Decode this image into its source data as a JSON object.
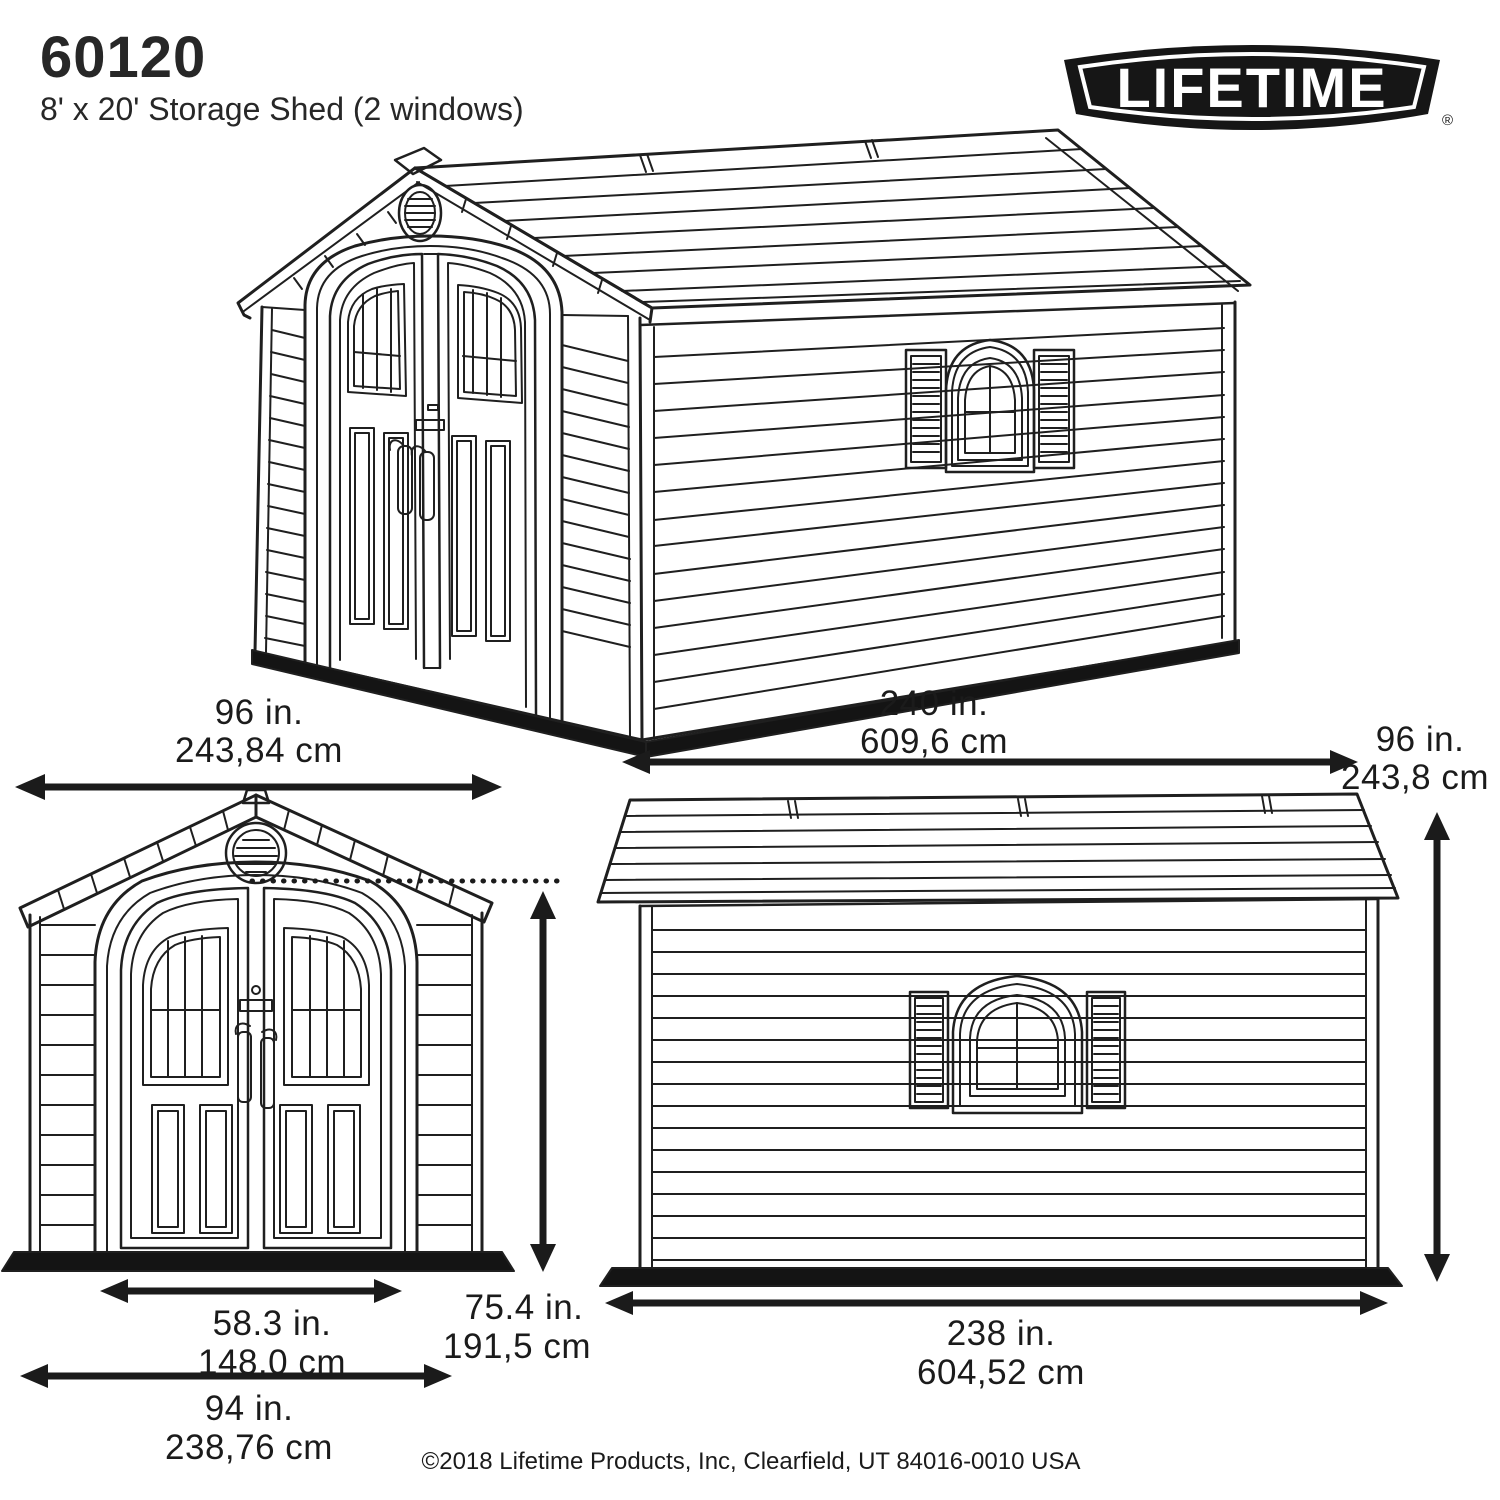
{
  "header": {
    "model_number": "60120",
    "product_title": "8' x 20' Storage Shed (2 windows)"
  },
  "logo": {
    "brand": "LIFETIME",
    "registered_mark": "®"
  },
  "dimensions": {
    "front_width_in": "96 in.",
    "front_width_cm": "243,84 cm",
    "length_in": "240 in.",
    "length_cm": "609,6 cm",
    "height_in": "96 in.",
    "height_cm": "243,8 cm",
    "door_width_in": "58.3 in.",
    "door_width_cm": "148,0 cm",
    "door_height_in": "75.4 in.",
    "door_height_cm": "191,5 cm",
    "base_width_in": "94 in.",
    "base_width_cm": "238,76 cm",
    "base_length_in": "238 in.",
    "base_length_cm": "604,52 cm"
  },
  "footer": {
    "copyright": "©2018 Lifetime Products, Inc, Clearfield, UT 84016-0010 USA"
  },
  "colors": {
    "line": "#1f1f1f",
    "background": "#ffffff",
    "base_strip": "#141414",
    "logo_fill": "#161616"
  }
}
